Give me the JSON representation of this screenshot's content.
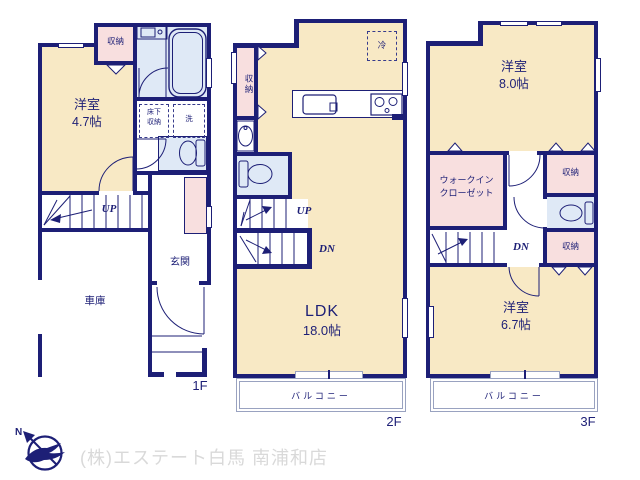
{
  "floors": {
    "f1": {
      "label": "1F",
      "main_room": {
        "name": "洋室",
        "area": "4.7帖"
      },
      "closet": "収納",
      "underfloor_storage": {
        "line1": "床下",
        "line2": "収納"
      },
      "laundry": "洗",
      "stairs_up": "UP",
      "entrance": "玄関",
      "garage": "車庫"
    },
    "f2": {
      "label": "2F",
      "closet": "収納",
      "refrigerator": "冷",
      "ldk": {
        "name": "LDK",
        "area": "18.0帖"
      },
      "stairs_up": "UP",
      "stairs_down": "DN",
      "balcony": "バルコニー"
    },
    "f3": {
      "label": "3F",
      "room_upper": {
        "name": "洋室",
        "area": "8.0帖"
      },
      "walk_in_closet": {
        "line1": "ウォークイン",
        "line2": "クローゼット"
      },
      "closet_upper": "収納",
      "closet_lower": "収納",
      "stairs_down": "DN",
      "room_lower": {
        "name": "洋室",
        "area": "6.7帖"
      },
      "balcony": "バルコニー"
    }
  },
  "compass": {
    "north": "N"
  },
  "footer": {
    "company": "(株)エステート白馬 南浦和店"
  },
  "colors": {
    "wall_navy": "#1d1f76",
    "room_cream": "#f8e9c5",
    "closet_pink": "#f8dfdf",
    "bath_blue": "#dfe9f6",
    "balcony_line": "#99a2c0",
    "footer_text": "#d9d9d9"
  }
}
